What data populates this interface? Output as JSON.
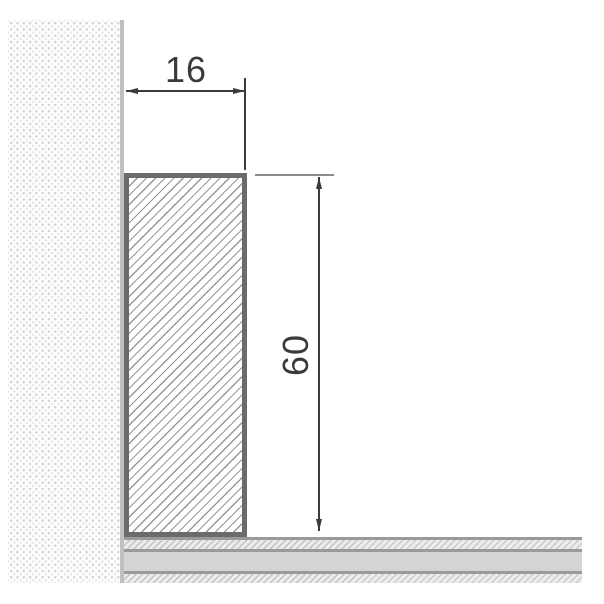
{
  "drawing": {
    "type": "technical-cross-section",
    "dimensions": {
      "width_label": "16",
      "height_label": "60"
    }
  },
  "colors": {
    "dimension_ink": "#3a3a3a",
    "extension_gray": "#8c8c8c",
    "profile_border": "#6b6b6b",
    "profile_hatch": "#979797",
    "wall_dot": "#d2d2d2",
    "wall_dot_light": "#e6e6e6",
    "wall_edge": "#c0c0c0",
    "floor_line": "#9a9a9a",
    "floor_solid": "#d4d4d4",
    "floor_hatch_bg": "#ececec",
    "floor_hatch_line": "#c2c2c2"
  }
}
